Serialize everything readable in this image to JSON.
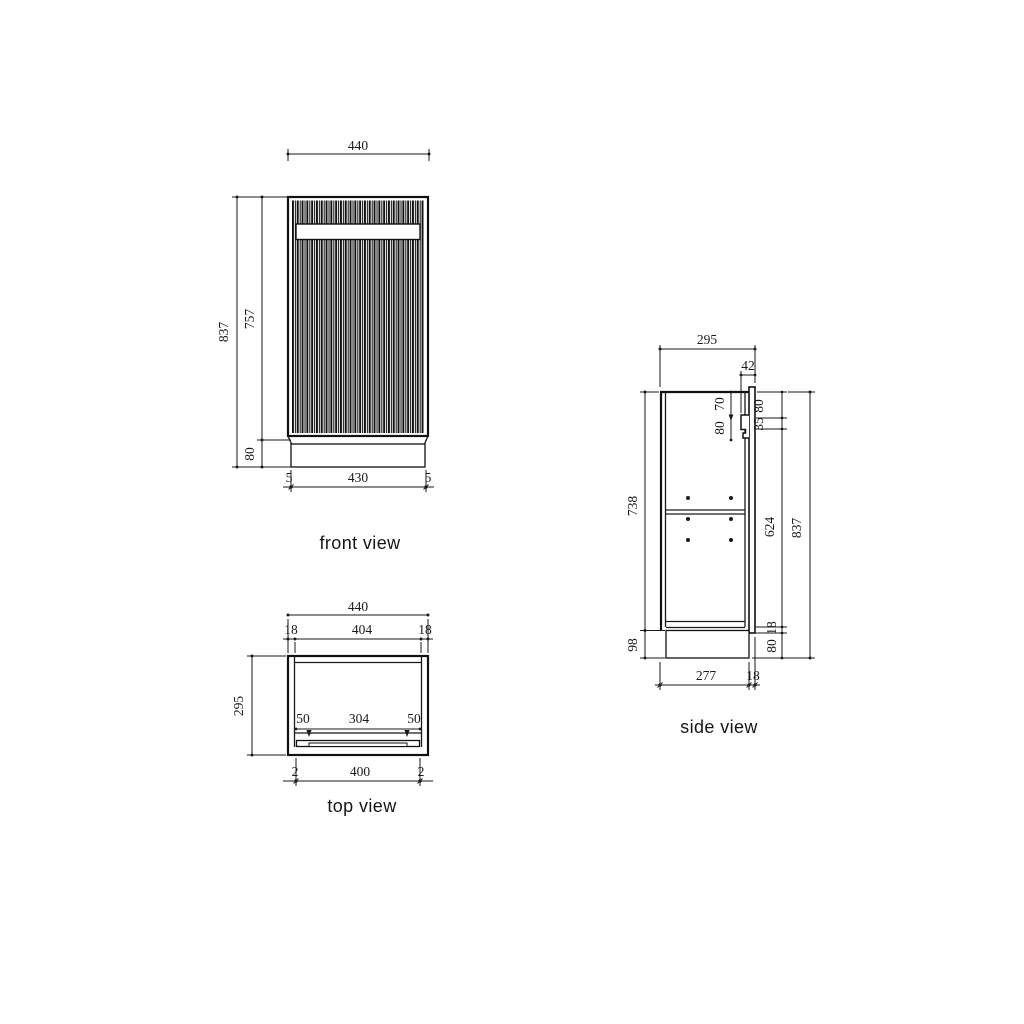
{
  "drawing": {
    "front": {
      "label": "front view",
      "width_top": "440",
      "height_overall": "837",
      "height_door": "757",
      "height_plinth": "80",
      "gap_left": "5",
      "plinth_width": "430",
      "gap_right": "5"
    },
    "top": {
      "label": "top view",
      "width_overall": "440",
      "wall_left": "18",
      "interior_width": "404",
      "wall_right": "18",
      "depth": "295",
      "handle_inset_left": "50",
      "handle_width": "304",
      "handle_inset_right": "50",
      "door_gap_left": "2",
      "door_width": "400",
      "door_gap_right": "2"
    },
    "side": {
      "label": "side view",
      "depth_top": "295",
      "front_assembly_depth": "42",
      "handle_offset_top": "70",
      "handle_zone_height": "80",
      "top_to_handle": "80",
      "handle_grip_height": "35",
      "interior_height": "624",
      "bottom_panel": "18",
      "plinth_height_right": "80",
      "height_overall": "837",
      "body_height": "738",
      "base_height": "98",
      "base_depth": "277",
      "door_thickness": "18"
    }
  },
  "colors": {
    "line": "#1a1a1a",
    "background": "#ffffff"
  }
}
